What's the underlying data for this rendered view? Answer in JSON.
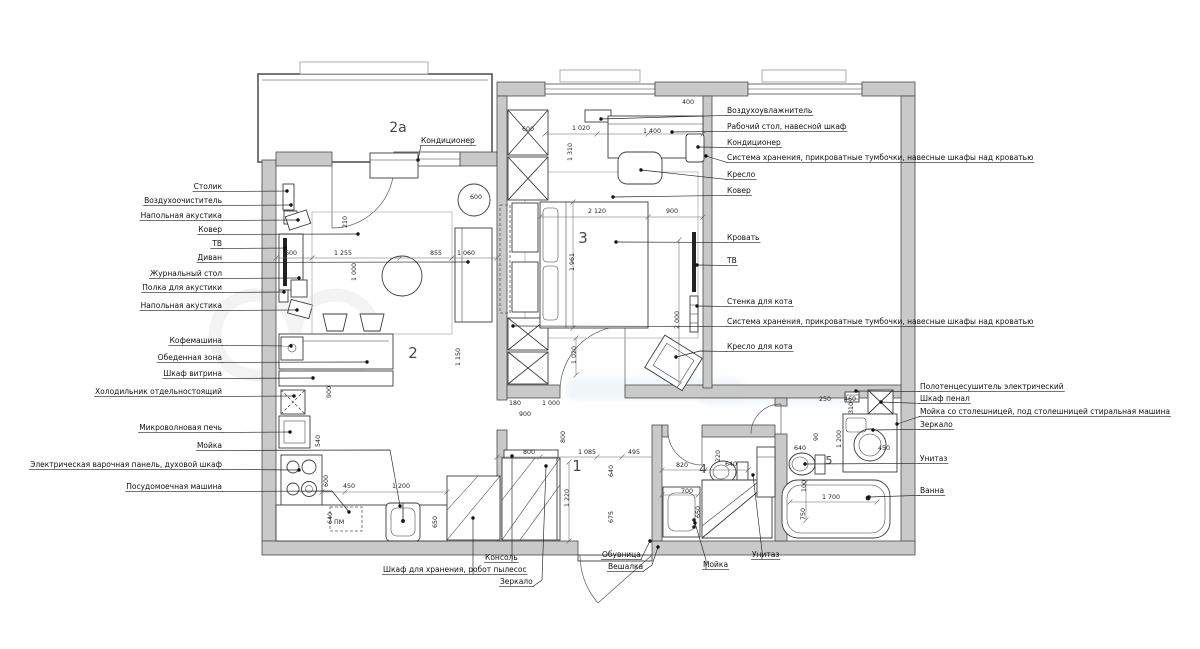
{
  "plan_title": "Apartment furniture plan",
  "room_numbers": [
    {
      "t": "2a",
      "x": 398,
      "y": 132,
      "s": 14
    },
    {
      "t": "2",
      "x": 413,
      "y": 358,
      "s": 15
    },
    {
      "t": "3",
      "x": 583,
      "y": 243,
      "s": 15
    },
    {
      "t": "1",
      "x": 577,
      "y": 471,
      "s": 15
    },
    {
      "t": "4",
      "x": 703,
      "y": 473,
      "s": 12
    },
    {
      "t": "5",
      "x": 829,
      "y": 464,
      "s": 11
    }
  ],
  "annotations": {
    "top": [
      {
        "t": "Кондиционер",
        "x": 421,
        "y": 143,
        "tg": [
          418,
          160
        ]
      }
    ],
    "left": [
      {
        "t": "Столик",
        "y": 189,
        "tg": [
          287,
          191
        ]
      },
      {
        "t": "Воздухоочиститель",
        "y": 203,
        "tg": [
          291,
          205
        ]
      },
      {
        "t": "Напольная акустика",
        "y": 218,
        "tg": [
          298,
          220
        ]
      },
      {
        "t": "Ковер",
        "y": 232,
        "tg": [
          358,
          234
        ]
      },
      {
        "t": "ТВ",
        "y": 246,
        "tg": [
          285,
          248
        ]
      },
      {
        "t": "Диван",
        "y": 260,
        "tg": [
          468,
          262
        ]
      },
      {
        "t": "Журнальный стол",
        "y": 276,
        "tg": [
          299,
          278
        ]
      },
      {
        "t": "Полка для акустики",
        "y": 290,
        "tg": [
          284,
          292
        ]
      },
      {
        "t": "Напольная акустика",
        "y": 308,
        "tg": [
          297,
          310
        ]
      },
      {
        "t": "Кофемашина",
        "y": 343,
        "tg": [
          291,
          346
        ]
      },
      {
        "t": "Обеденная зона",
        "y": 360,
        "tg": [
          367,
          362
        ]
      },
      {
        "t": "Шкаф витрина",
        "y": 376,
        "tg": [
          313,
          378
        ]
      },
      {
        "t": "Холодильник отдельностоящий",
        "y": 394,
        "tg": [
          294,
          396
        ]
      },
      {
        "t": "Микроволновая печь",
        "y": 430,
        "tg": [
          290,
          432
        ]
      },
      {
        "t": "Мойка",
        "y": 448,
        "via": [
          [
            390,
            450
          ]
        ],
        "tg": [
          400,
          506
        ]
      },
      {
        "t": "Электрическая варочная панель, духовой шкаф",
        "y": 467,
        "tg": [
          299,
          470
        ]
      },
      {
        "t": "Посудомоечная машина",
        "y": 489,
        "via": [
          [
            332,
            491
          ]
        ],
        "tg": [
          349,
          512
        ]
      }
    ],
    "right": [
      {
        "t": "Воздухоувлажнитель",
        "y": 113,
        "tg": [
          601,
          119
        ]
      },
      {
        "t": "Рабочий стол, навесной шкаф",
        "y": 129,
        "tg": [
          672,
          132
        ]
      },
      {
        "t": "Кондиционер",
        "y": 145,
        "tg": [
          698,
          147
        ]
      },
      {
        "t": "Система хранения, прикроватные тумбочки, навесные шкафы над кроватью",
        "y": 160,
        "tg": [
          706,
          156
        ]
      },
      {
        "t": "Кресло",
        "y": 177,
        "tg": [
          641,
          170
        ]
      },
      {
        "t": "Ковер",
        "y": 193,
        "tg": [
          613,
          197
        ]
      },
      {
        "t": "Кровать",
        "y": 240,
        "tg": [
          616,
          242
        ]
      },
      {
        "t": "ТВ",
        "y": 263,
        "tg": [
          697,
          265
        ]
      },
      {
        "t": "Стенка для кота",
        "y": 304,
        "tg": [
          697,
          306
        ]
      },
      {
        "t": "Система хранения, прикроватные тумбочки, навесные шкафы над кроватью",
        "y": 324,
        "tg": [
          513,
          326
        ]
      },
      {
        "t": "Кресло для кота",
        "y": 349,
        "via": [
          [
            700,
            351
          ]
        ],
        "tg": [
          676,
          357
        ]
      }
    ],
    "right_lower": [
      {
        "t": "Полотенцесушитель электрический",
        "y": 389,
        "tg": [
          856,
          391
        ]
      },
      {
        "t": "Шкаф пенал",
        "y": 401,
        "tg": [
          881,
          402
        ]
      },
      {
        "t": "Мойка со столешницей, под столешницей стиральная машина",
        "y": 414,
        "tg": [
          897,
          424
        ]
      },
      {
        "t": "Зеркало",
        "y": 427,
        "tg": [
          873,
          430
        ]
      },
      {
        "t": "Унитаз",
        "y": 461,
        "tg": [
          805,
          464
        ]
      },
      {
        "t": "Ванна",
        "y": 493,
        "tg": [
          869,
          497
        ]
      }
    ],
    "bottom": [
      {
        "t": "Консоль",
        "x": 485,
        "y": 560,
        "via": [
          [
            512,
            556
          ]
        ],
        "tg": [
          512,
          456
        ]
      },
      {
        "t": "Шкаф для хранения, робот пылесос",
        "x": 383,
        "y": 572,
        "via": [
          [
            473,
            568
          ]
        ],
        "tg": [
          473,
          518
        ]
      },
      {
        "t": "Зеркало",
        "x": 500,
        "y": 584,
        "via": [
          [
            542,
            580
          ]
        ],
        "tg": [
          546,
          466
        ]
      },
      {
        "t": "Обувница",
        "x": 602,
        "y": 557,
        "tg": [
          650,
          541
        ]
      },
      {
        "t": "Вешалка",
        "x": 608,
        "y": 569,
        "via": [
          [
            652,
            565
          ]
        ],
        "tg": [
          658,
          547
        ]
      },
      {
        "t": "Мойка",
        "x": 703,
        "y": 567,
        "via": [
          [
            706,
            560
          ]
        ],
        "tg": [
          695,
          523
        ]
      },
      {
        "t": "Унитаз",
        "x": 752,
        "y": 557,
        "via": [
          [
            762,
            551
          ]
        ],
        "tg": [
          753,
          475
        ]
      }
    ]
  },
  "misc_texts": [
    {
      "t": "ПМ",
      "x": 334,
      "y": 524,
      "s": 9
    }
  ],
  "dimensions": [
    {
      "t": "400",
      "x": 688,
      "y": 104
    },
    {
      "t": "1 020",
      "x": 581,
      "y": 130
    },
    {
      "t": "1 400",
      "x": 652,
      "y": 133
    },
    {
      "t": "600",
      "x": 528,
      "y": 131
    },
    {
      "t": "2 120",
      "x": 597,
      "y": 213
    },
    {
      "t": "900",
      "x": 672,
      "y": 213
    },
    {
      "t": "1 961",
      "x": 574,
      "y": 262,
      "r": 1
    },
    {
      "t": "2 000",
      "x": 679,
      "y": 320,
      "r": 1
    },
    {
      "t": "1 020",
      "x": 576,
      "y": 355,
      "r": 1
    },
    {
      "t": "1 310",
      "x": 572,
      "y": 152,
      "r": 1
    },
    {
      "t": "600",
      "x": 291,
      "y": 255
    },
    {
      "t": "1 255",
      "x": 343,
      "y": 255
    },
    {
      "t": "855",
      "x": 436,
      "y": 255
    },
    {
      "t": "1 060",
      "x": 466,
      "y": 255
    },
    {
      "t": "1 000",
      "x": 356,
      "y": 272,
      "r": 1
    },
    {
      "t": "1 150",
      "x": 460,
      "y": 357,
      "r": 1
    },
    {
      "t": "210",
      "x": 347,
      "y": 222,
      "r": 1
    },
    {
      "t": "900",
      "x": 331,
      "y": 392,
      "r": 1
    },
    {
      "t": "600",
      "x": 476,
      "y": 199
    },
    {
      "t": "540",
      "x": 320,
      "y": 441,
      "r": 1
    },
    {
      "t": "600",
      "x": 328,
      "y": 481,
      "r": 1
    },
    {
      "t": "450",
      "x": 349,
      "y": 488
    },
    {
      "t": "1 200",
      "x": 401,
      "y": 488
    },
    {
      "t": "640",
      "x": 332,
      "y": 518,
      "r": 1
    },
    {
      "t": "650",
      "x": 437,
      "y": 522,
      "r": 1
    },
    {
      "t": "180",
      "x": 515,
      "y": 405
    },
    {
      "t": "1 000",
      "x": 551,
      "y": 405
    },
    {
      "t": "900",
      "x": 525,
      "y": 416
    },
    {
      "t": "800",
      "x": 565,
      "y": 437,
      "r": 1
    },
    {
      "t": "800",
      "x": 529,
      "y": 454
    },
    {
      "t": "1 085",
      "x": 587,
      "y": 454
    },
    {
      "t": "495",
      "x": 634,
      "y": 454
    },
    {
      "t": "640",
      "x": 613,
      "y": 471,
      "r": 1
    },
    {
      "t": "675",
      "x": 613,
      "y": 517,
      "r": 1
    },
    {
      "t": "1 220",
      "x": 569,
      "y": 498,
      "r": 1
    },
    {
      "t": "820",
      "x": 682,
      "y": 467
    },
    {
      "t": "700",
      "x": 687,
      "y": 493
    },
    {
      "t": "640",
      "x": 731,
      "y": 466
    },
    {
      "t": "220",
      "x": 720,
      "y": 456,
      "r": 1
    },
    {
      "t": "650",
      "x": 700,
      "y": 512,
      "r": 1
    },
    {
      "t": "250",
      "x": 825,
      "y": 401
    },
    {
      "t": "460",
      "x": 850,
      "y": 401
    },
    {
      "t": "310",
      "x": 853,
      "y": 408,
      "r": 1
    },
    {
      "t": "1 200",
      "x": 841,
      "y": 439,
      "r": 1
    },
    {
      "t": "90",
      "x": 818,
      "y": 437,
      "r": 1
    },
    {
      "t": "640",
      "x": 800,
      "y": 450
    },
    {
      "t": "450",
      "x": 884,
      "y": 450
    },
    {
      "t": "1 700",
      "x": 831,
      "y": 499
    },
    {
      "t": "750",
      "x": 805,
      "y": 514,
      "r": 1
    },
    {
      "t": "100",
      "x": 806,
      "y": 486,
      "r": 1
    }
  ],
  "dim_lines": [
    {
      "p": [
        540,
        217,
        703,
        217
      ],
      "t": [
        [
          540,
          217
        ],
        [
          648,
          217
        ],
        [
          703,
          217
        ]
      ]
    },
    {
      "p": [
        573,
        202,
        573,
        328
      ],
      "t": [
        [
          573,
          202
        ],
        [
          573,
          328
        ]
      ]
    },
    {
      "p": [
        679,
        240,
        679,
        385
      ],
      "t": [
        [
          679,
          240
        ],
        [
          679,
          385
        ]
      ]
    },
    {
      "p": [
        276,
        258,
        497,
        258
      ],
      "t": [
        [
          276,
          258
        ],
        [
          312,
          258
        ],
        [
          400,
          258
        ],
        [
          452,
          258
        ],
        [
          497,
          258
        ]
      ]
    },
    {
      "p": [
        322,
        492,
        447,
        492
      ],
      "t": [
        [
          322,
          492
        ],
        [
          345,
          492
        ],
        [
          447,
          492
        ]
      ]
    },
    {
      "p": [
        497,
        457,
        652,
        457
      ],
      "t": [
        [
          497,
          457
        ],
        [
          540,
          457
        ],
        [
          597,
          457
        ],
        [
          622,
          457
        ]
      ]
    },
    {
      "p": [
        662,
        470,
        748,
        470
      ],
      "t": [
        [
          662,
          470
        ],
        [
          705,
          470
        ],
        [
          748,
          470
        ]
      ]
    },
    {
      "p": [
        662,
        495,
        698,
        495
      ],
      "t": [
        [
          662,
          495
        ],
        [
          698,
          495
        ]
      ]
    },
    {
      "p": [
        790,
        502,
        877,
        502
      ],
      "t": [
        [
          790,
          502
        ],
        [
          877,
          502
        ]
      ]
    },
    {
      "p": [
        806,
        482,
        806,
        520
      ],
      "t": [
        [
          806,
          482
        ],
        [
          806,
          520
        ]
      ]
    },
    {
      "p": [
        545,
        134,
        703,
        134
      ],
      "t": [
        [
          545,
          134
        ],
        [
          597,
          134
        ],
        [
          648,
          134
        ],
        [
          703,
          134
        ]
      ]
    },
    {
      "p": [
        569,
        462,
        569,
        541
      ],
      "t": [
        [
          569,
          462
        ],
        [
          569,
          541
        ]
      ]
    },
    {
      "p": [
        576,
        338,
        576,
        375
      ],
      "t": [
        [
          576,
          338
        ],
        [
          576,
          375
        ]
      ]
    }
  ]
}
